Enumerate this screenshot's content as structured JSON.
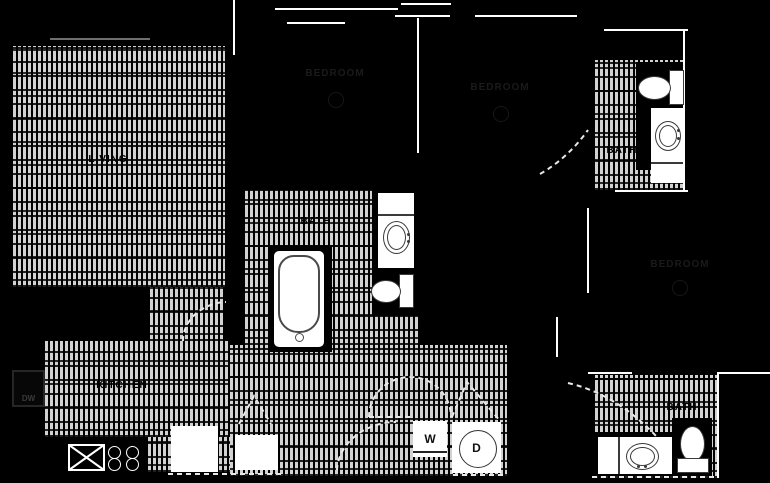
{
  "plan": {
    "type": "apartment-floor-plan",
    "rooms": {
      "living": "LIVING",
      "kitchen": "KITCHEN",
      "bath_center": "BATH",
      "bath_upper_right": "BATH",
      "bath_lower_right": "BATH",
      "bedroom_top_left": "BEDROOM",
      "bedroom_top_right": "BEDROOM",
      "bedroom_right": "BEDROOM"
    },
    "appliances": {
      "washer": "W",
      "dryer": "D",
      "dishwasher": "DW"
    },
    "colors": {
      "background": "#000000",
      "floor_hatch": "#d2d2d2",
      "walls": "#ffffff",
      "fixture_outline": "#3a3a3a",
      "faint_text": "#1a1a1a"
    }
  }
}
